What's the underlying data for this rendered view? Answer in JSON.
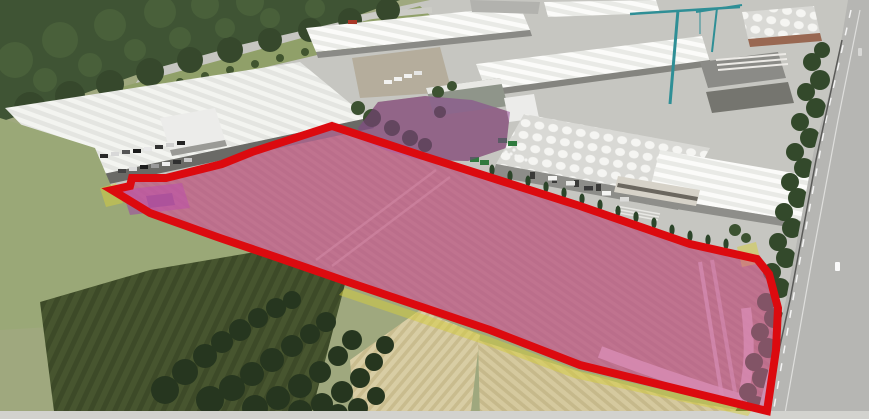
{
  "image": {
    "kind": "aerial-drone-photograph",
    "subject": "industrial-park-with-highlighted-land-parcel",
    "width_px": 869,
    "height_px": 419
  },
  "annotations": {
    "boundary_color": "#dc0a0f",
    "boundary_width": 8,
    "main_parcel": {
      "name": "highlighted-land-parcel",
      "fill": "rgba(226,98,176,0.45)",
      "points": [
        [
          332,
          126
        ],
        [
          420,
          155
        ],
        [
          580,
          206
        ],
        [
          690,
          244
        ],
        [
          757,
          259
        ],
        [
          769,
          274
        ],
        [
          778,
          308
        ],
        [
          776,
          350
        ],
        [
          767,
          411
        ],
        [
          580,
          365
        ],
        [
          490,
          330
        ],
        [
          345,
          281
        ],
        [
          270,
          255
        ],
        [
          220,
          238
        ],
        [
          150,
          213
        ],
        [
          112,
          190
        ],
        [
          130,
          186
        ],
        [
          132,
          178
        ],
        [
          166,
          178
        ],
        [
          222,
          164
        ],
        [
          252,
          152
        ]
      ]
    },
    "secondary_parcel": {
      "name": "secondary-purple-area",
      "fill": "rgba(138,58,142,0.50)",
      "points": [
        [
          358,
          128
        ],
        [
          378,
          102
        ],
        [
          425,
          96
        ],
        [
          472,
          100
        ],
        [
          510,
          112
        ],
        [
          506,
          148
        ],
        [
          468,
          161
        ],
        [
          420,
          160
        ],
        [
          385,
          150
        ],
        [
          362,
          140
        ]
      ]
    },
    "building_highlight": {
      "name": "small-purple-building-area",
      "fill": "rgba(158,66,168,0.55)",
      "points": [
        [
          122,
          190
        ],
        [
          182,
          183
        ],
        [
          190,
          208
        ],
        [
          130,
          215
        ]
      ]
    },
    "yellow_fill": "rgba(214,206,60,0.50)",
    "yellow_areas": [
      [
        [
          100,
          188
        ],
        [
          116,
          183
        ],
        [
          123,
          203
        ],
        [
          106,
          207
        ]
      ],
      [
        [
          737,
          247
        ],
        [
          756,
          242
        ],
        [
          761,
          263
        ],
        [
          742,
          267
        ]
      ],
      [
        [
          345,
          288
        ],
        [
          490,
          337
        ],
        [
          580,
          371
        ],
        [
          752,
          410
        ],
        [
          748,
          416
        ],
        [
          574,
          378
        ],
        [
          483,
          344
        ],
        [
          339,
          295
        ]
      ]
    ]
  }
}
